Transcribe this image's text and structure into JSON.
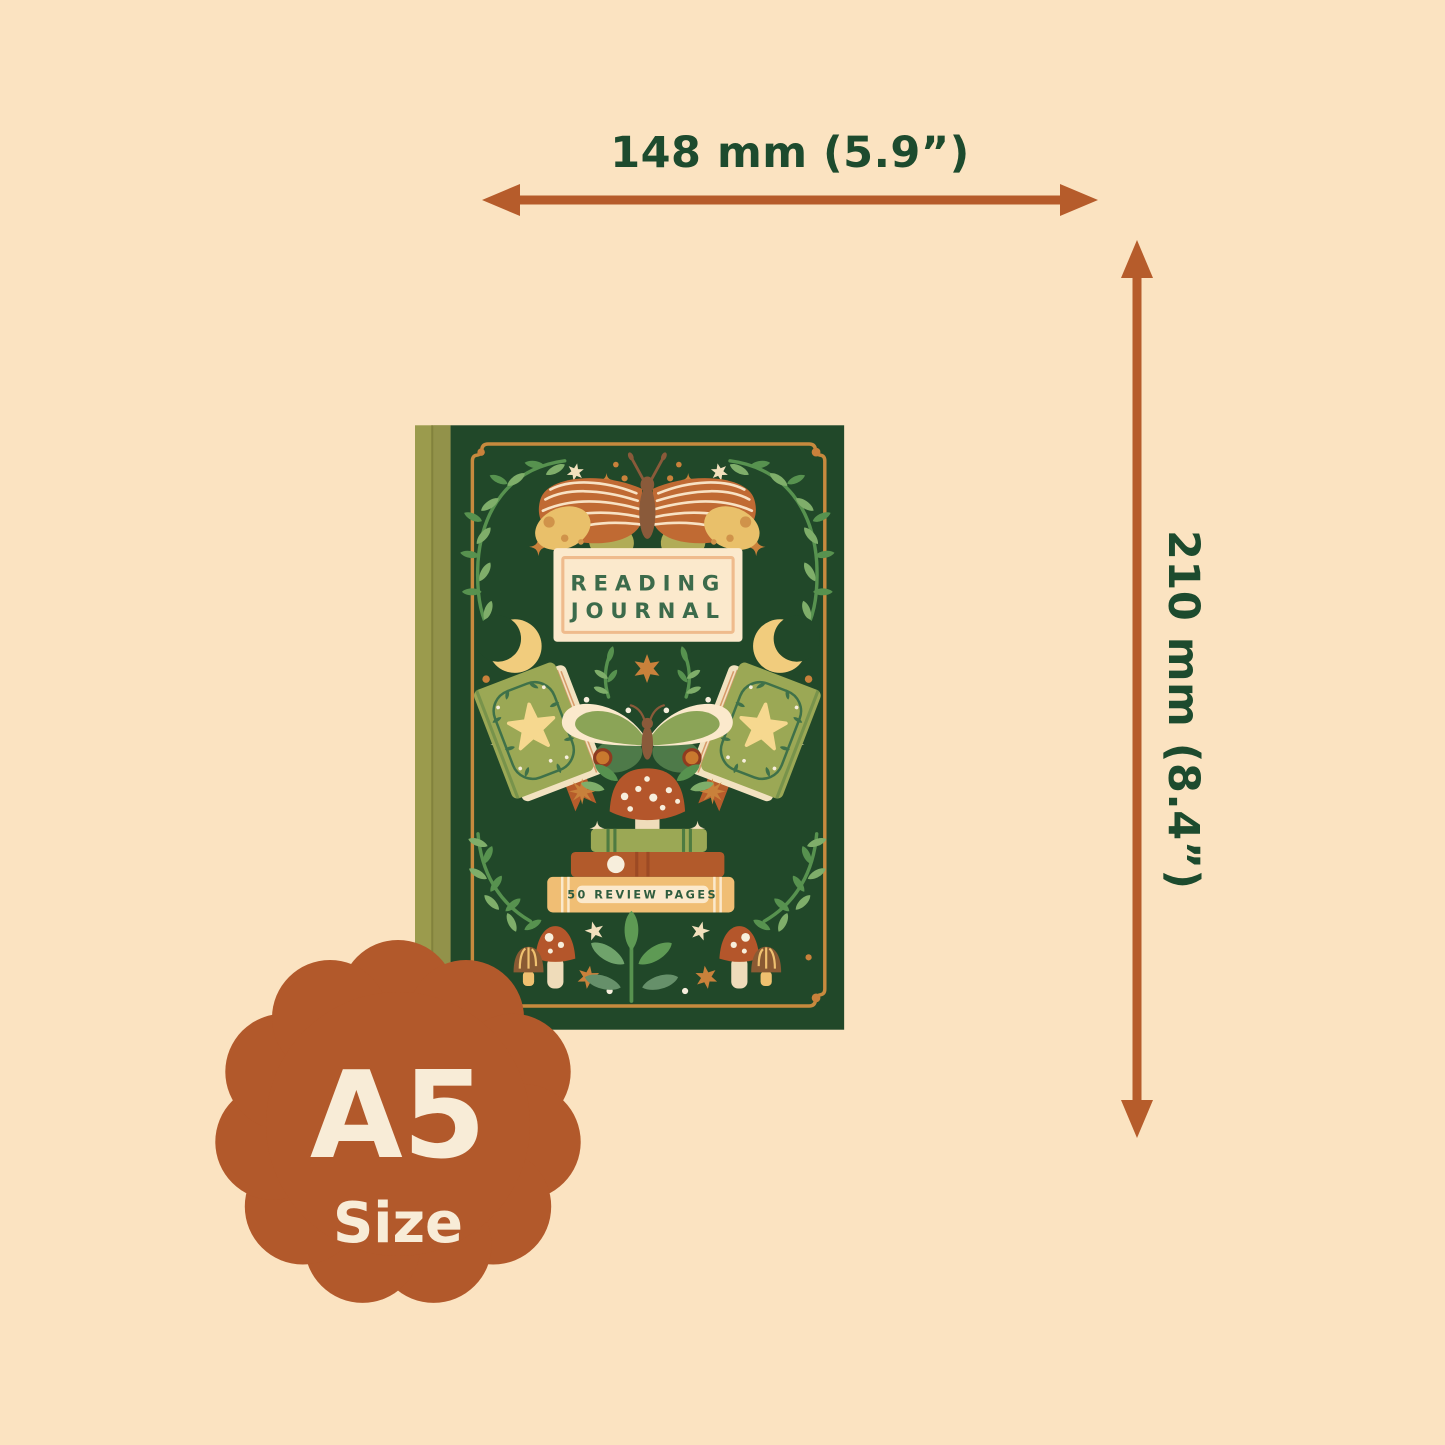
{
  "annotations": {
    "width_label": "148 mm (5.9”)",
    "height_label": "210 mm (8.4”)"
  },
  "book_cover": {
    "title_line1": "READING",
    "title_line2": "JOURNAL",
    "review_pages_label": "50 REVIEW PAGES"
  },
  "badge": {
    "size_code": "A5",
    "size_word": "Size"
  },
  "colors": {
    "bg": "#FBE3C1",
    "rust": "#B65C2B",
    "badge": "#B2592B",
    "badge_text": "#F8ECD7",
    "dim_text": "#1D4B2E",
    "cover": "#214829",
    "spine": "#9B9B4D",
    "spine_line": "#82823D",
    "spine_shade": "#92924A",
    "gold": "#C78A3E",
    "gold_star": "#C9813B",
    "cream": "#F2E0BD",
    "cream_light": "#FBE9CC",
    "dot_white": "#F7EEDC",
    "box_border": "#EFBB8C",
    "title_text": "#3C6B4B",
    "moon": "#F1CC7D",
    "vine1": "#57924F",
    "vine2": "#7FAE6A",
    "vine_dark": "#3F7149",
    "leaf_bright": "#5E9A54",
    "leaf_mid": "#6FA36B",
    "leaf_sage": "#66906A",
    "book_olive": "#9BA855",
    "stripe_dark": "#4E7B41",
    "rust_book": "#B25A2B",
    "rust_dark": "#9C4A24",
    "tan_book": "#F0BE74",
    "label_text": "#2F5D3F",
    "mush_cap": "#B4562B",
    "mush_stem": "#EFDCBA",
    "brown": "#8A5A33",
    "tan": "#EFC170",
    "body_brown": "#8A5A3A",
    "wing_rust": "#C06A33",
    "wing_olive": "#B1AC57",
    "wing_tan": "#E9C06A",
    "wing_dot": "#D0934A",
    "bfly_green": "#8BA457",
    "bfly_dark": "#4E7A49",
    "eye_orange": "#C9792E",
    "eye_ring": "#8F3B20",
    "star_pale": "#F6D88F",
    "page_edge": "#F2E2C0",
    "page_line": "#D89A6A"
  },
  "decorations": [
    "moth-icon",
    "crescent-moon-icon",
    "star-icons",
    "sparkle-icons",
    "leafy-vines",
    "magic-book-icons",
    "butterfly-icon",
    "toadstool-icon",
    "book-stack",
    "leaf-sprig"
  ]
}
